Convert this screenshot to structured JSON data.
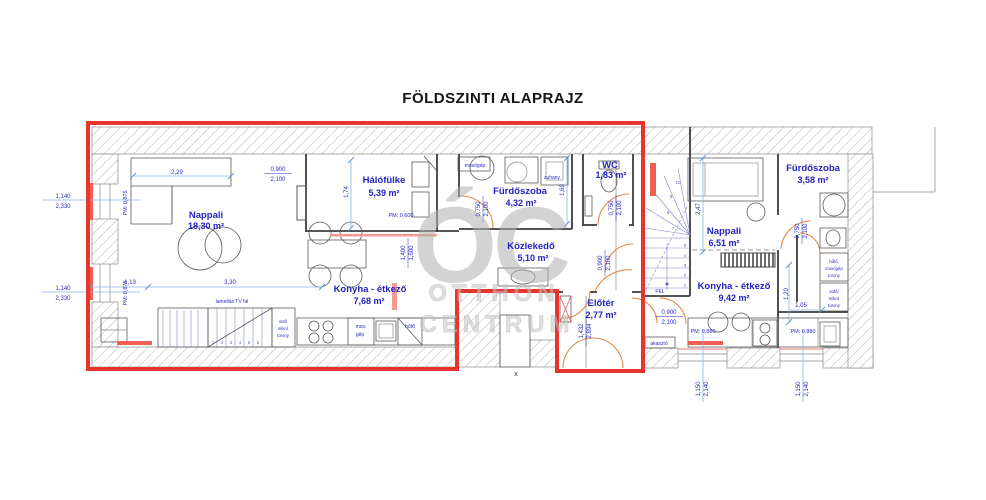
{
  "title": "FÖLDSZINTI ALAPRAJZ",
  "watermark": {
    "logo": "ÓC",
    "line1": "OTTHON",
    "line2": "CENTRUM"
  },
  "rooms": {
    "nappali1": {
      "name": "Nappali",
      "area": "18,30 m²"
    },
    "halofulke": {
      "name": "Hálófülke",
      "area": "5,39 m²"
    },
    "furdoszoba1": {
      "name": "Fürdőszoba",
      "area": "4,32 m²"
    },
    "wc": {
      "name": "WC",
      "area": "1,83 m²"
    },
    "kozlekedo": {
      "name": "Közlekedő",
      "area": "5,10 m²"
    },
    "konyha1": {
      "name": "Konyha - étkező",
      "area": "7,68 m²"
    },
    "eloter": {
      "name": "Előtér",
      "area": "2,77 m²"
    },
    "nappali2": {
      "name": "Nappali",
      "area": "6,51 m²"
    },
    "konyha2": {
      "name": "Konyha - étkező",
      "area": "9,42 m²"
    },
    "furdoszoba2": {
      "name": "Fürdőszoba",
      "area": "3,58 m²"
    }
  },
  "labels": {
    "mosogep": "mosógép",
    "zuhany": "zuhany",
    "mos_gep_1": "mos.",
    "mos_gep_2": "gép",
    "huto": "hűtő",
    "tv_fal": "lamellás TV fal",
    "akaszto": "akasztó",
    "fel": "FEL",
    "x_mark": "x",
    "tower_r1_1": "hűtő,",
    "tower_r1_2": "mosógép",
    "tower_r1_3": "torony",
    "tower_r2_1": "sütő/",
    "tower_r2_2": "mikró",
    "tower_r2_3": "torony",
    "tower_l_1": "sütő",
    "tower_l_2": "mikró",
    "tower_l_3": "torony"
  },
  "dims": {
    "v229": "2,29",
    "v113": "1,13",
    "v330": "3,30",
    "v174": "1,74",
    "v169": "1,69",
    "v247": "2,47",
    "v120": "1,20",
    "v105": "1,05",
    "w900": "0,900",
    "h2100": "2,100",
    "w750": "0,750",
    "w1140": "1,140",
    "h2330": "2,330",
    "w1150": "1,150",
    "h2140": "2,140",
    "v1400": "1,400",
    "v1500": "1,500",
    "v1432": "1,432",
    "v2894": "2,894",
    "pm875": "PM: 0,875",
    "pm600": "PM: 0,600",
    "pm880": "PM: 0,880"
  },
  "stairs": {
    "n1": "1",
    "n2": "2",
    "n3": "3",
    "n4": "4",
    "n5": "5",
    "n6": "6",
    "n7": "7",
    "n8": "8",
    "n9": "9",
    "n10": "10"
  }
}
